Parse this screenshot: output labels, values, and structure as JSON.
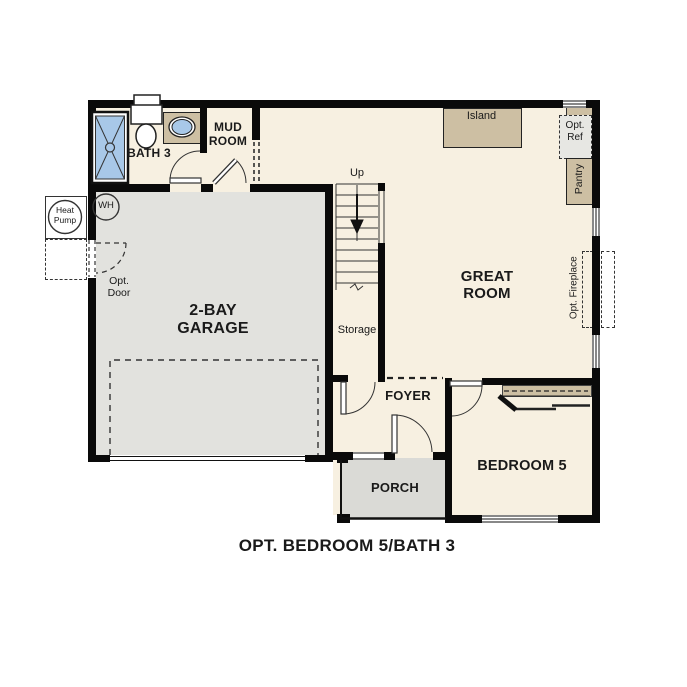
{
  "caption": "OPT. BEDROOM 5/BATH 3",
  "rooms": {
    "great_room": "GREAT ROOM",
    "garage": "2-BAY GARAGE",
    "bedroom5": "BEDROOM 5",
    "foyer": "FOYER",
    "porch": "PORCH",
    "mud_room": "MUD ROOM",
    "bath3": "BATH 3",
    "storage": "Storage"
  },
  "features": {
    "island": "Island",
    "pantry": "Pantry",
    "opt_ref": "Opt. Ref",
    "opt_fireplace": "Opt. Fireplace",
    "opt_door": "Opt. Door",
    "heat_pump": "Heat Pump",
    "water_heater": "WH",
    "stairs_up": "Up"
  },
  "colors": {
    "wall": "#0a0a0a",
    "floor": "#f7f0e1",
    "garage_floor": "#e2e2de",
    "porch_floor": "#dadad6",
    "casework_tan": "#cdbfa3",
    "fixture_blue": "#a8c8e8",
    "opt_ref_fill": "#e7e7e3",
    "background": "#ffffff"
  }
}
